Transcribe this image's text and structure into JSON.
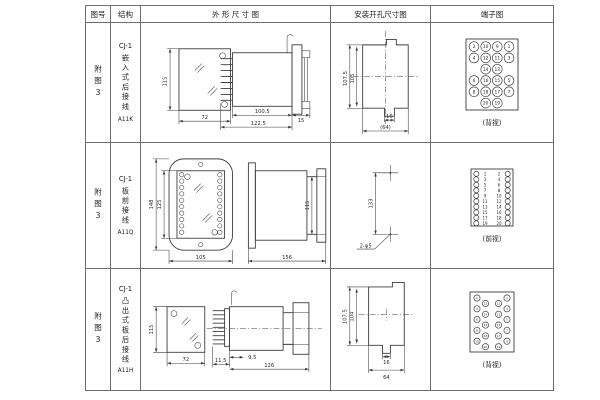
{
  "line_color": "#3c3c3c",
  "header": {
    "fig_no": "图号",
    "structure": "结构",
    "outline": "外 形 尺 寸 图",
    "mounting": "安装开孔尺寸图",
    "terminal": "端子图"
  },
  "rows": [
    {
      "fig_no": "附图3",
      "model": "CJ-1",
      "wiring": "嵌入式后接线",
      "code": "A11K",
      "outline": {
        "front_height": "115",
        "front_width": "72",
        "depth": "100.5",
        "total_depth": "122.5",
        "flange": "15"
      },
      "mounting": {
        "outer_height": "107.5",
        "inner_height": "105",
        "slot_width": "16",
        "total_width": "(64)"
      },
      "terminal": {
        "view_label": "(背视)",
        "grid": [
          [
            "2",
            "10",
            "9",
            "1"
          ],
          [
            "4",
            "12",
            "11",
            "3"
          ],
          [
            "",
            "14",
            "13",
            ""
          ],
          [
            "6",
            "16",
            "15",
            "5"
          ],
          [
            "8",
            "18",
            "17",
            "7"
          ],
          [
            "",
            "20",
            "19",
            ""
          ]
        ]
      }
    },
    {
      "fig_no": "附图3",
      "model": "CJ-1",
      "wiring": "板前接线",
      "code": "A11Q",
      "outline": {
        "front_outer_height": "148",
        "front_inner_height": "125",
        "front_width": "105",
        "side_length": "156",
        "side_height": "115"
      },
      "mounting": {
        "hole_spacing": "133",
        "holes_label": "2-φ5"
      },
      "terminal": {
        "view_label": "(前视)",
        "pairs": [
          [
            "1",
            "2"
          ],
          [
            "3",
            "4"
          ],
          [
            "5",
            "6"
          ],
          [
            "7",
            "8"
          ],
          [
            "9",
            "10"
          ],
          [
            "11",
            "12"
          ],
          [
            "13",
            "14"
          ],
          [
            "15",
            "16"
          ],
          [
            "17",
            "18"
          ],
          [
            "19",
            "20"
          ]
        ]
      }
    },
    {
      "fig_no": "附图3",
      "model": "CJ-1",
      "wiring": "凸出式板后接线",
      "code": "A11H",
      "outline": {
        "front_height": "115",
        "front_width": "72",
        "pin_depth": "11.5",
        "gap": "9.5",
        "body_length": "126"
      },
      "mounting": {
        "outer_height": "107.5",
        "inner_height": "104",
        "slot_width": "16",
        "total_width": "64"
      },
      "terminal": {
        "view_label": "(背视)",
        "zigzag": [
          "2",
          "4",
          "6",
          "8",
          "10",
          "12",
          "14",
          "16",
          "18",
          "20",
          "11",
          "13",
          "15",
          "17",
          "19",
          "1",
          "3",
          "5",
          "7",
          "9"
        ]
      }
    }
  ]
}
